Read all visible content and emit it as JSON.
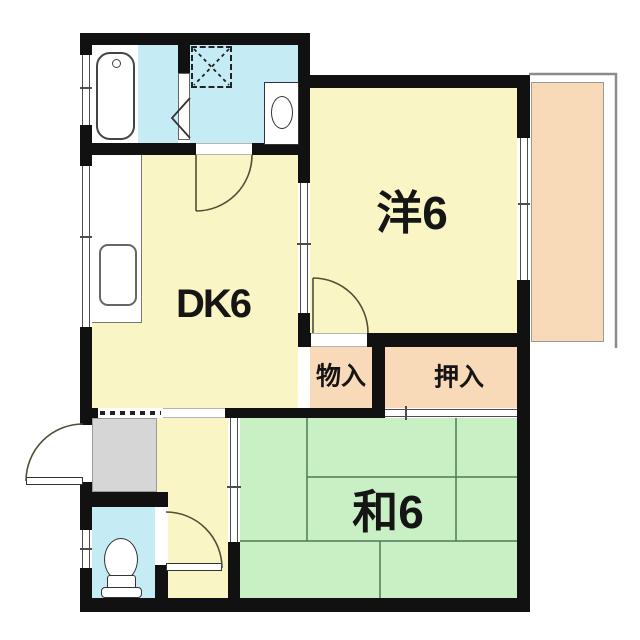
{
  "plan": {
    "rooms": {
      "dk": "DK6",
      "western": "洋6",
      "japanese": "和6",
      "storage": "物入",
      "closet": "押入"
    },
    "colors": {
      "wall": "#111111",
      "room-yellow": "#f9f5c4",
      "water-blue": "#c5ecf5",
      "tatami-green": "#c9efc5",
      "peach": "#f8d9b8",
      "genkan-gray": "#d6d6d6",
      "door-line": "#4f4f38",
      "tatami-line": "#4f7a55",
      "rail-gray": "#8c8c8c",
      "fixture-line": "#333333",
      "ink": "#151515"
    }
  }
}
